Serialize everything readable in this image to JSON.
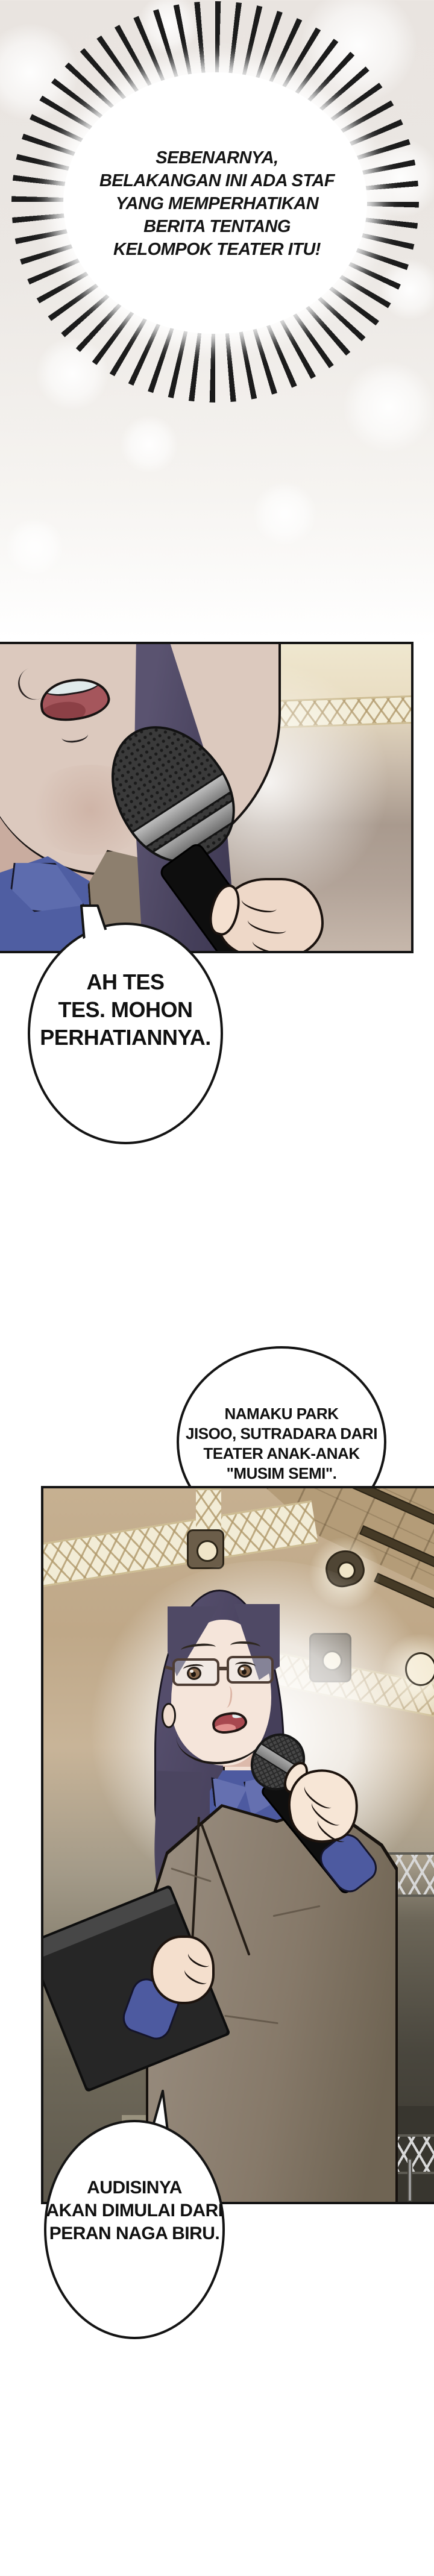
{
  "page": {
    "kind": "webtoon comic page",
    "background_top_color": "#e9e4e0",
    "background_bottom_color": "#ffffff",
    "outline_color": "#141414",
    "bubble_fill": "#ffffff"
  },
  "dialogue": {
    "burst_caption": {
      "style": "spiky burst bubble",
      "text": "SEBENARNYA,\nBELAKANGAN INI ADA STAF\nYANG MEMPERHATIKAN\nBERITA TENTANG\nKELOMPOK TEATER ITU!"
    },
    "bubble_mic_test": {
      "style": "oval speech bubble",
      "text": "AH TES\nTES. MOHON\nPERHATIANNYA."
    },
    "bubble_introduction": {
      "style": "round speech bubble",
      "text": "NAMAKU PARK\nJISOO, SUTRADARA DARI\nTEATER ANAK-ANAK\n\"MUSIM SEMI\"."
    },
    "bubble_audition": {
      "style": "oval speech bubble",
      "text": "AUDISINYA\nAKAN DIMULAI DARI\nPERAN NAGA BIRU."
    }
  },
  "panels": {
    "panel_mic_closeup": "close-up of a speaker's mouth talking into a handheld microphone on a stage",
    "panel_director": "woman with glasses (Park Jisoo) holding a microphone and a black folder under stage truss lighting"
  },
  "colors": {
    "skin": "#f5e5da",
    "hair": "#4b4560",
    "shirt_blue": "#4d5aa0",
    "blazer_taupe": "#867969",
    "stage_tan": "#bfa888",
    "stage_dark_olive": "#38362f",
    "mouth_red": "#a8484f"
  }
}
